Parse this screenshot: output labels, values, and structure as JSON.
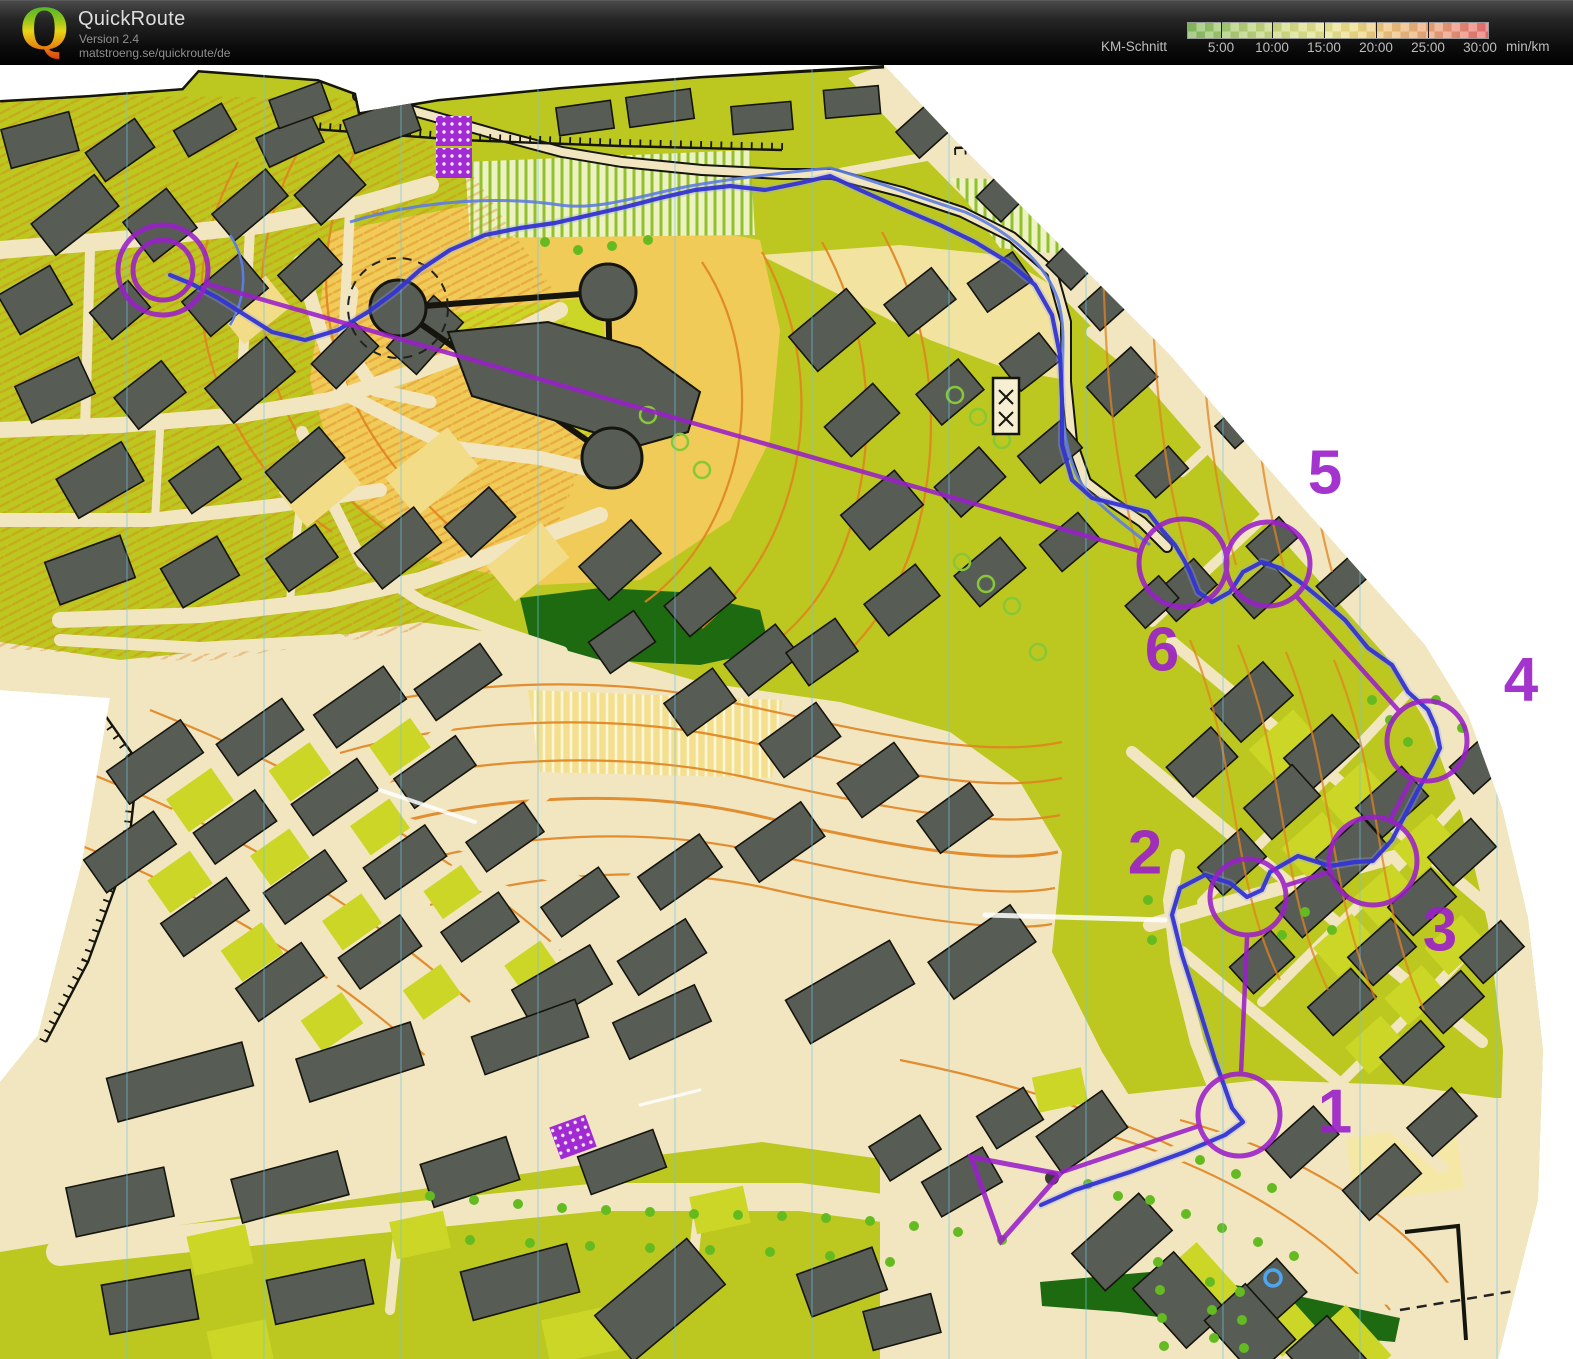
{
  "header": {
    "logo_letter": "Q",
    "app_name": "QuickRoute",
    "version": "Version 2.4",
    "website": "matstroeng.se/quickroute/de",
    "legend": {
      "label": "KM-Schnitt",
      "unit": "min/km",
      "ticks": [
        "5:00",
        "10:00",
        "15:00",
        "20:00",
        "25:00",
        "30:00"
      ]
    }
  },
  "map": {
    "description": "Scanned sprint-orienteering city map with hand-drawn purple course and blue GPS route",
    "contour_label": "80",
    "course_color": "#9a1fc9",
    "route_color": "#3434d2",
    "controls": [
      {
        "label": "1"
      },
      {
        "label": "2"
      },
      {
        "label": "3"
      },
      {
        "label": "4"
      },
      {
        "label": "5"
      },
      {
        "label": "6"
      }
    ]
  }
}
